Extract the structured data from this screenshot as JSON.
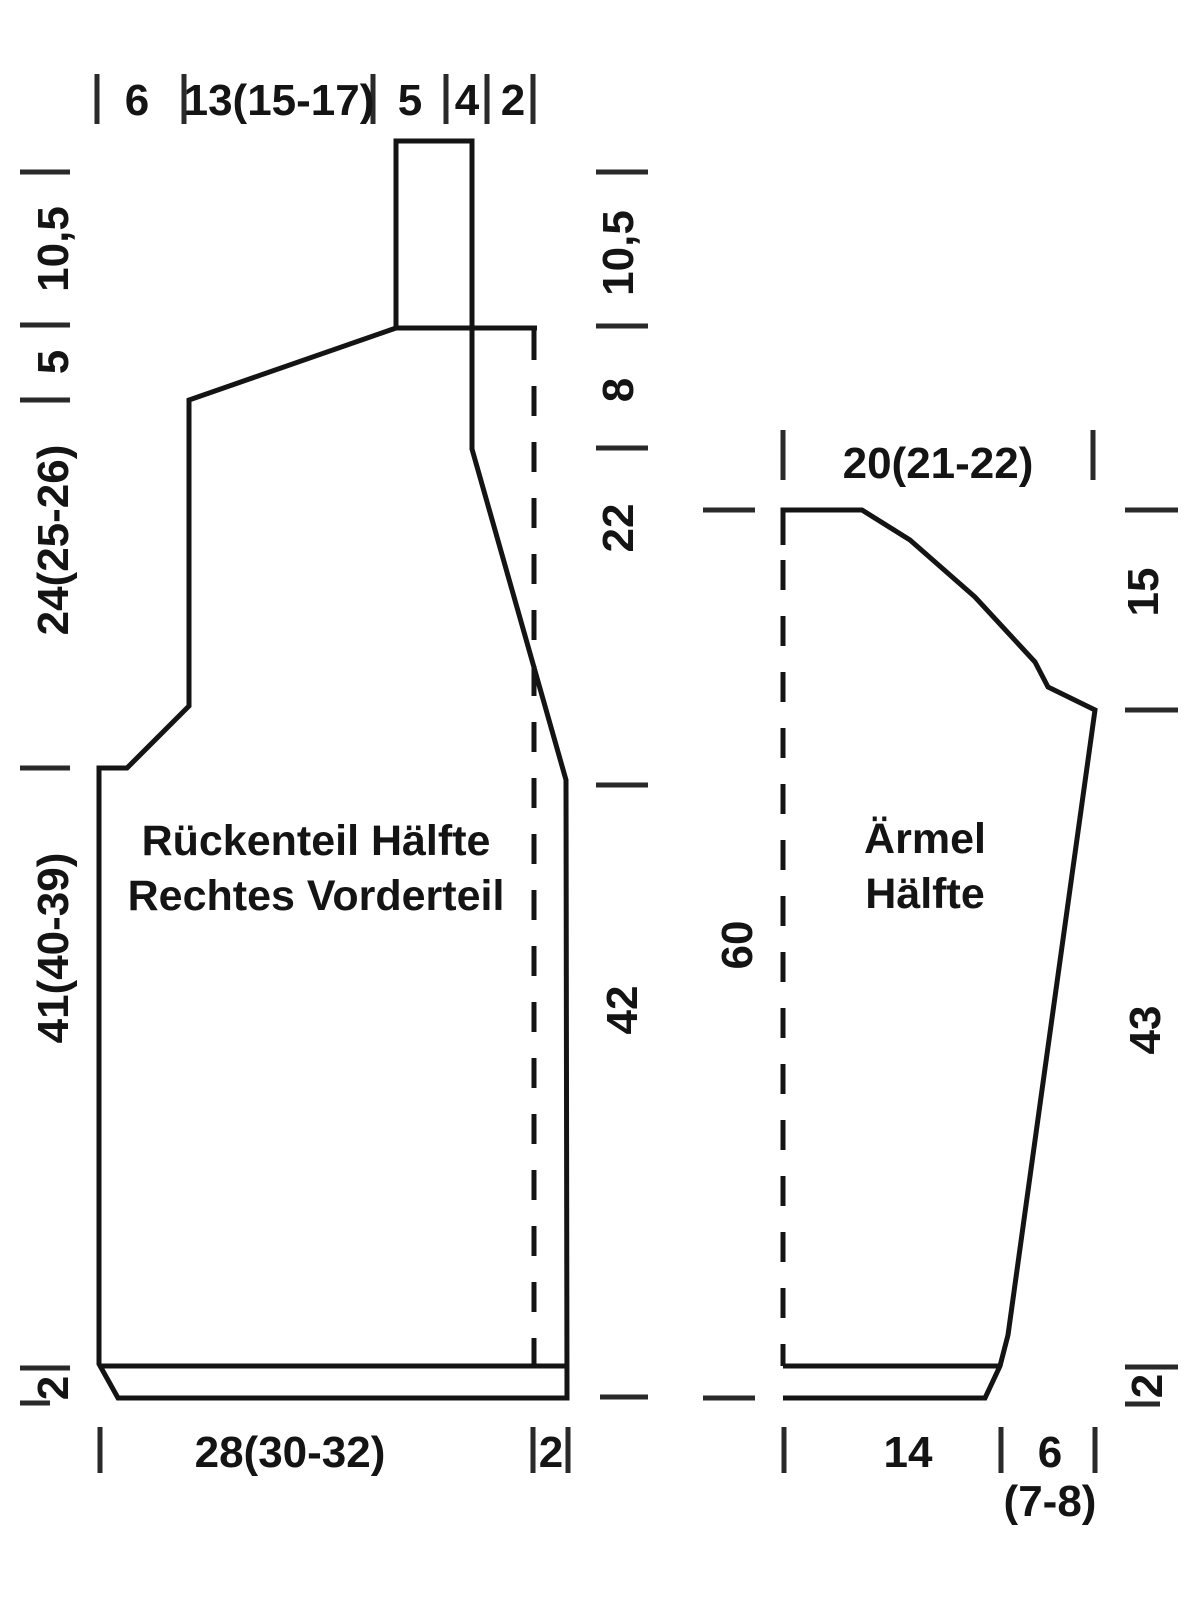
{
  "left_piece": {
    "label": [
      "Rückenteil Hälfte",
      "Rechtes Vorderteil"
    ],
    "top_measures": [
      "6",
      "13(15-17)",
      "5",
      "4",
      "2"
    ],
    "left_measures": [
      "10,5",
      "5",
      "24(25-26)",
      "41(40-39)",
      "2"
    ],
    "inner_measures": [
      "10,5",
      "8",
      "22",
      "42"
    ],
    "bottom_measures": [
      "28(30-32)",
      "2"
    ]
  },
  "right_piece": {
    "label": [
      "Ärmel",
      "Hälfte"
    ],
    "top_measures": [
      "20(21-22)"
    ],
    "left_measures": [
      "60"
    ],
    "right_measures": [
      "15",
      "43",
      "2"
    ],
    "bottom_measures": [
      "14",
      "6",
      "(7-8)"
    ]
  },
  "colors": {
    "line": "#141414",
    "background": "#ffffff"
  }
}
